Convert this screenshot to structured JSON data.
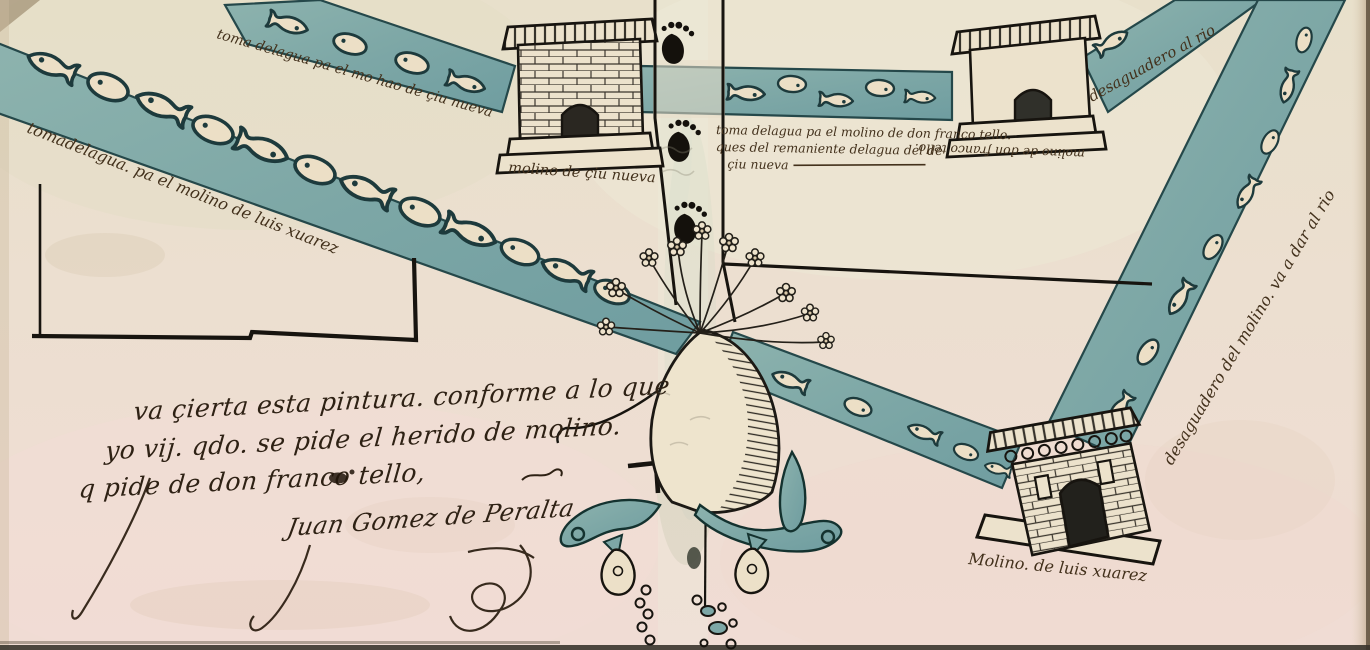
{
  "artwork": {
    "colors": {
      "paper": "#e9dcc8",
      "paper_pink": "#efdcd2",
      "water_teal": "#7da7a6",
      "ink_brown": "#43311c",
      "ink_dark": "#2e2114",
      "outline_teal": "#1d3a3c"
    },
    "labels": {
      "intake_luis_xuarez": "tomadelagua. pa el molino de luis xuarez",
      "intake_new_city": "toma delagua pa el mo hao de çiu nueva",
      "mill_new_city": "molino de çiu nueva",
      "tello_line1": "toma delagua pa el molino de don franco tello.",
      "tello_line2": "ques del remaniente delagua del de",
      "tello_line3": "çiu nueva",
      "drain_to_river": "desaguadero al rio",
      "mill_tello": "molino de don franco tello.",
      "drain_mill_to_river": "desaguadero del molino. va a dar al rio",
      "attestation_line1": "va çierta esta pintura. conforme a lo que",
      "attestation_line2": "yo vij. qdo. se pide el herido de molino.",
      "attestation_line3": "q pide de don franco tello,",
      "signature": "Juan Gomez de Peralta",
      "mill_luis_xuarez": "Molino. de luis xuarez"
    }
  }
}
